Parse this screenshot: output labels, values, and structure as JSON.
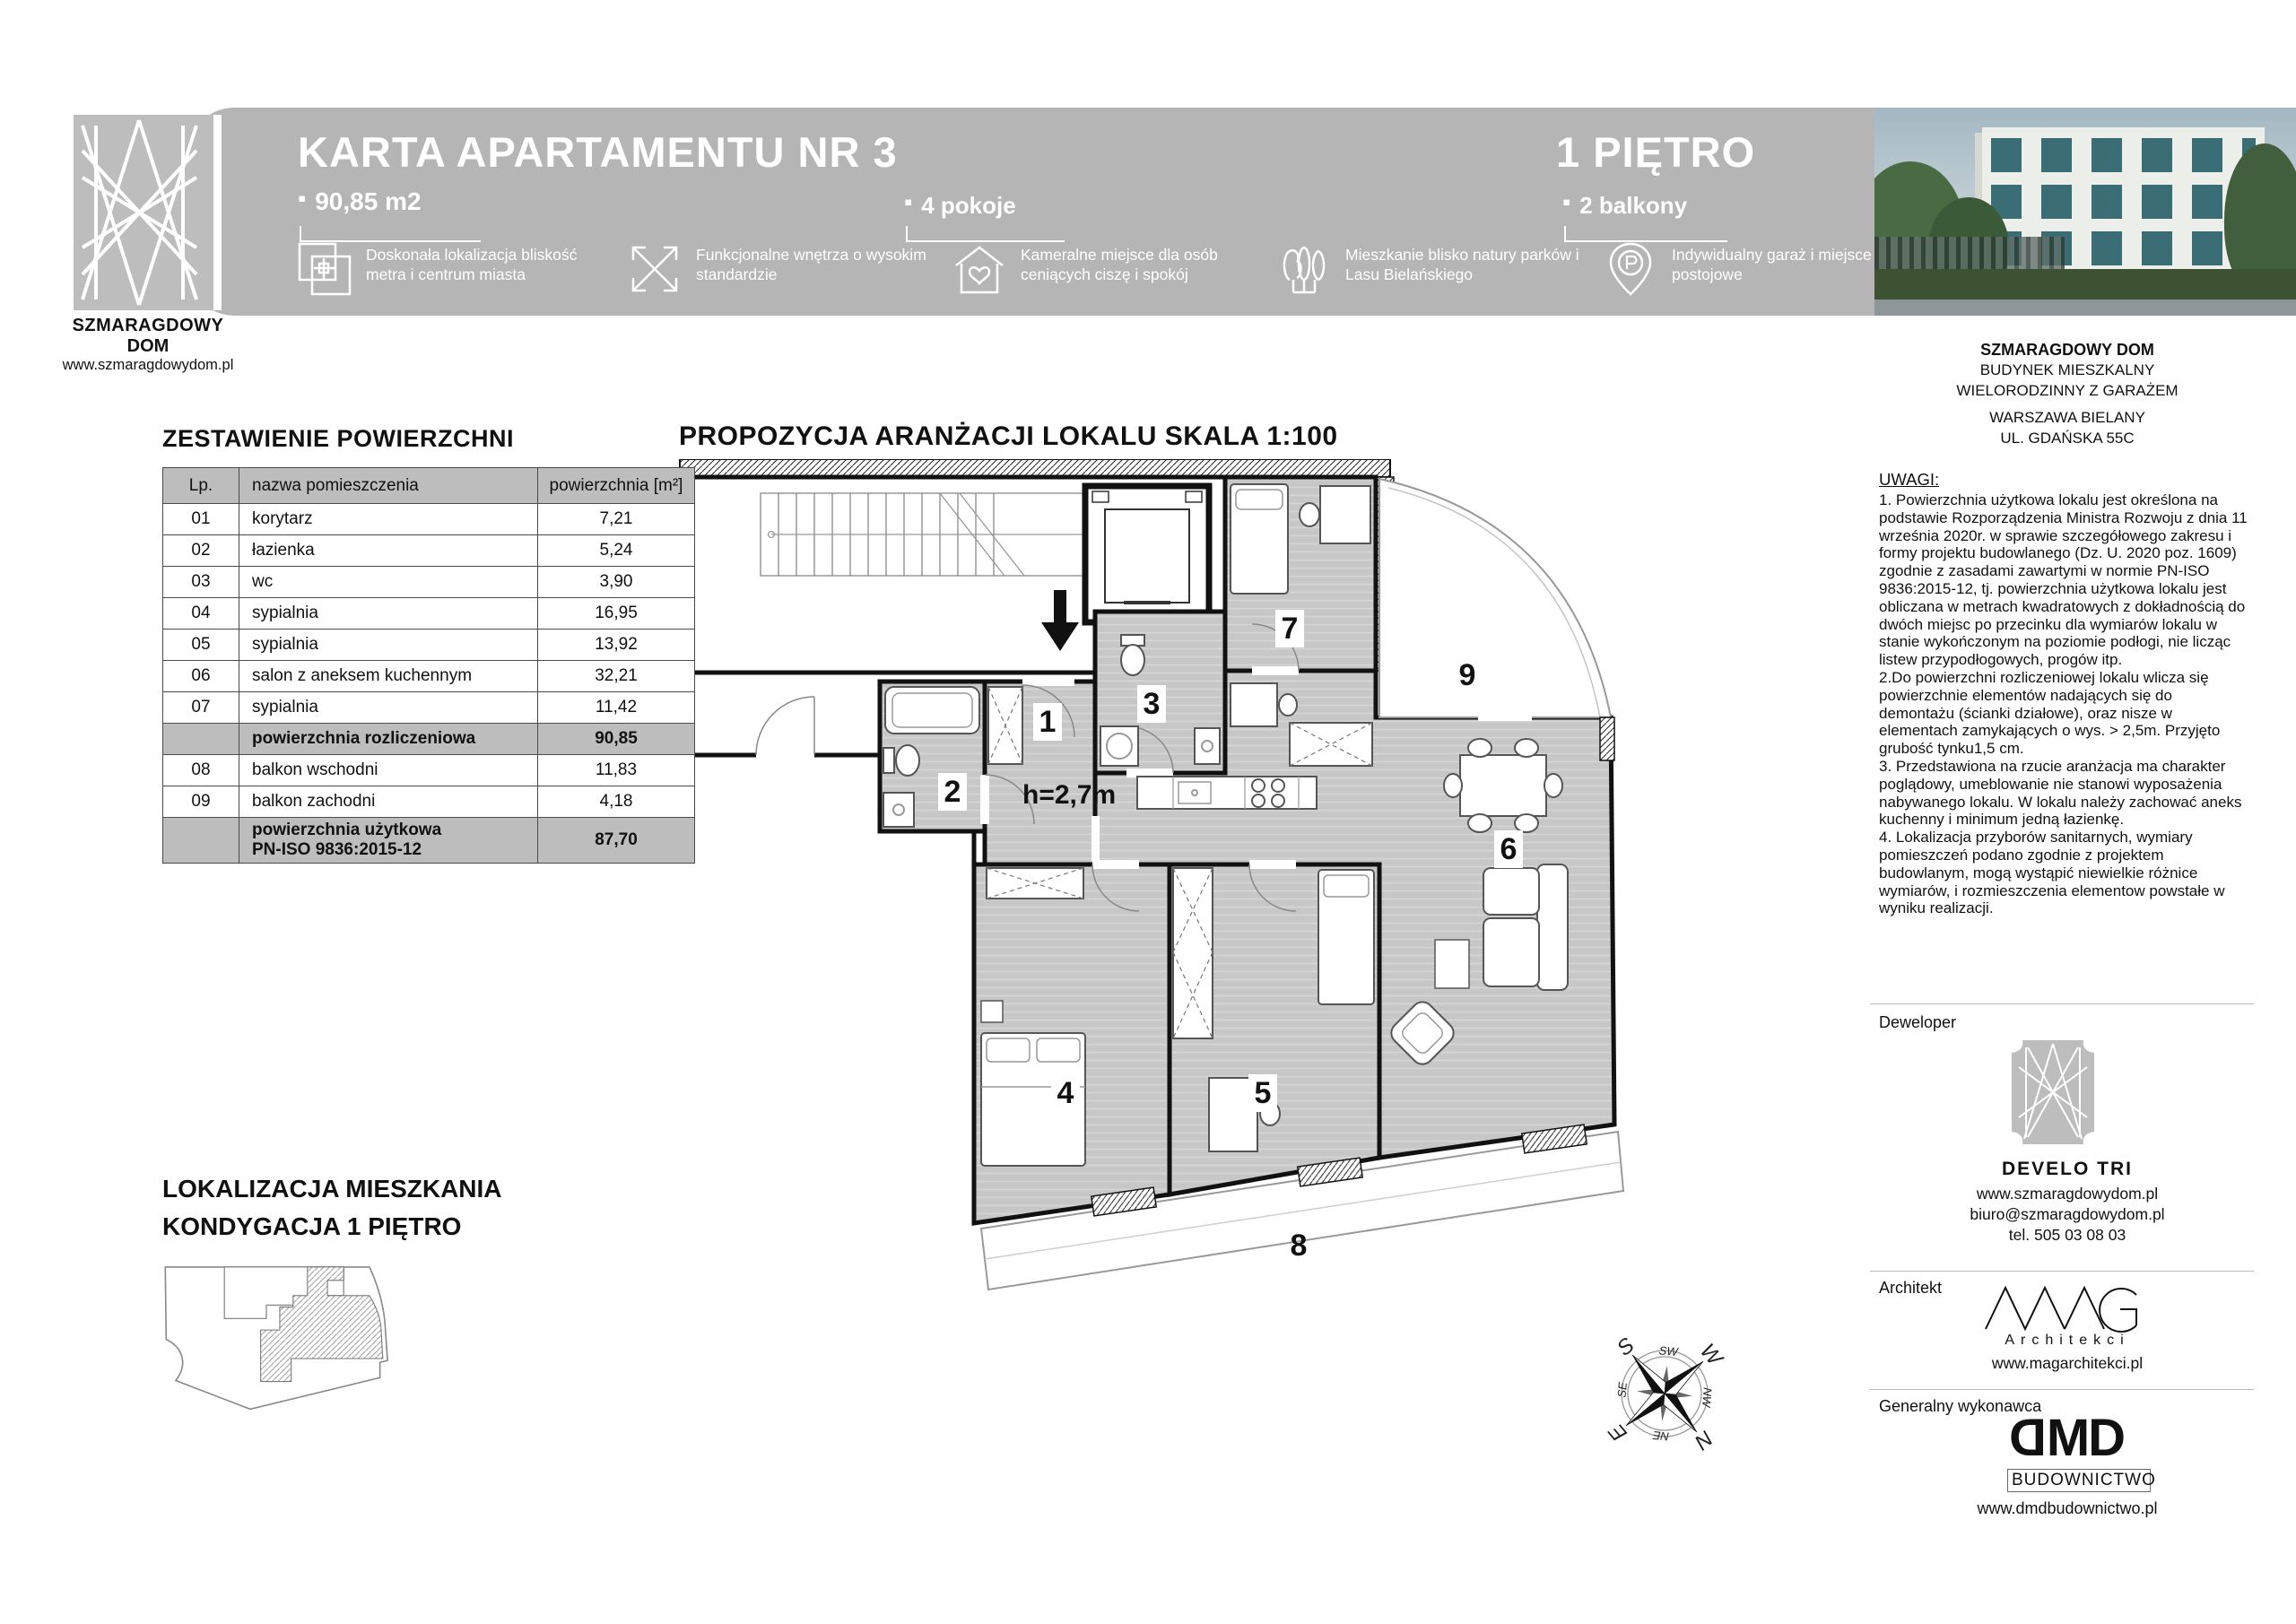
{
  "brand": {
    "line1": "SZMARAGDOWY",
    "line2": "DOM",
    "url": "www.szmaragdowydom.pl"
  },
  "header": {
    "title": "KARTA APARTAMENTU NR 3",
    "area": "90,85 m2",
    "rooms": "4 pokoje",
    "floor": "1 PIĘTRO",
    "balconies": "2 balkony",
    "bullet": "▪",
    "features": [
      {
        "icon": "location-squares-icon",
        "text": "Doskonała lokalizacja bliskość metra i centrum miasta"
      },
      {
        "icon": "expand-arrows-icon",
        "text": "Funkcjonalne wnętrza o wysokim standardzie"
      },
      {
        "icon": "house-heart-icon",
        "text": "Kameralne miejsce dla osób ceniących ciszę i spokój"
      },
      {
        "icon": "trees-icon",
        "text": "Mieszkanie blisko natury parków i Lasu Bielańskiego"
      },
      {
        "icon": "parking-pin-icon",
        "text": "Indywidualny garaż i miejsce postojowe"
      }
    ]
  },
  "areas": {
    "heading": "ZESTAWIENIE POWIERZCHNI",
    "columns": {
      "lp": "Lp.",
      "name": "nazwa pomieszczenia",
      "area": "powierzchnia [m²]"
    },
    "rows": [
      {
        "lp": "01",
        "name": "korytarz",
        "area": "7,21",
        "subtotal": false
      },
      {
        "lp": "02",
        "name": "łazienka",
        "area": "5,24",
        "subtotal": false
      },
      {
        "lp": "03",
        "name": "wc",
        "area": "3,90",
        "subtotal": false
      },
      {
        "lp": "04",
        "name": "sypialnia",
        "area": "16,95",
        "subtotal": false
      },
      {
        "lp": "05",
        "name": "sypialnia",
        "area": "13,92",
        "subtotal": false
      },
      {
        "lp": "06",
        "name": "salon z aneksem kuchennym",
        "area": "32,21",
        "subtotal": false
      },
      {
        "lp": "07",
        "name": "sypialnia",
        "area": "11,42",
        "subtotal": false
      },
      {
        "lp": "",
        "name": "powierzchnia rozliczeniowa",
        "area": "90,85",
        "subtotal": true
      },
      {
        "lp": "08",
        "name": "balkon wschodni",
        "area": "11,83",
        "subtotal": false
      },
      {
        "lp": "09",
        "name": "balkon zachodni",
        "area": "4,18",
        "subtotal": false
      },
      {
        "lp": "",
        "name": "powierzchnia użytkowa",
        "name2": "PN-ISO 9836:2015-12",
        "area": "87,70",
        "subtotal": true
      }
    ]
  },
  "plan": {
    "heading": "PROPOZYCJA ARANŻACJI LOKALU SKALA 1:100",
    "height_label": "h=2,7m",
    "rooms": [
      "1",
      "2",
      "3",
      "4",
      "5",
      "6",
      "7",
      "8",
      "9"
    ],
    "compass": {
      "n": "N",
      "e": "E",
      "s": "S",
      "w": "W",
      "ne": "NE",
      "nw": "NW",
      "se": "SE",
      "sw": "SW"
    }
  },
  "location": {
    "heading_line1": "LOKALIZACJA MIESZKANIA",
    "heading_line2": "KONDYGACJA 1 PIĘTRO"
  },
  "sidebar": {
    "project_lines": [
      "SZMARAGDOWY DOM",
      "BUDYNEK MIESZKALNY",
      "WIELORODZINNY Z GARAŻEM"
    ],
    "address_lines": [
      "WARSZAWA BIELANY",
      "UL. GDAŃSKA 55C"
    ],
    "notes_heading": "UWAGI:",
    "notes": [
      "1. Powierzchnia użytkowa lokalu jest określona na podstawie Rozporządzenia Ministra Rozwoju z dnia 11 września 2020r. w sprawie szczegółowego zakresu i formy projektu budowlanego (Dz. U. 2020 poz. 1609) zgodnie z zasadami zawartymi w normie PN-ISO 9836:2015-12, tj. powierzchnia użytkowa lokalu jest obliczana w metrach kwadratowych z dokładnością do dwóch miejsc po przecinku dla wymiarów lokalu w stanie wykończonym na poziomie podłogi, nie licząc listew przypodłogowych, progów itp.",
      "2.Do powierzchni rozliczeniowej lokalu wlicza się powierzchnie elementów nadających się do demontażu (ścianki działowe), oraz nisze w elementach zamykających o wys. > 2,5m. Przyjęto grubość tynku1,5 cm.",
      "3. Przedstawiona na rzucie aranżacja ma charakter poglądowy, umeblowanie nie stanowi wyposażenia nabywanego lokalu. W lokalu należy zachować aneks kuchenny i minimum jedną łazienkę.",
      "4. Lokalizacja przyborów sanitarnych, wymiary pomieszczeń podano zgodnie z projektem budowlanym, mogą wystąpić niewielkie różnice wymiarów, i rozmieszczenia elementow powstałe w wyniku realizacji."
    ],
    "developer": {
      "label": "Deweloper",
      "name": "DEVELO TRI",
      "www": "www.szmaragdowydom.pl",
      "email": "biuro@szmaragdowydom.pl",
      "tel": "tel. 505 03 08 03"
    },
    "architect": {
      "label": "Architekt",
      "logo_sub": "Architekci",
      "www": "www.magarchitekci.pl"
    },
    "contractor": {
      "label": "Generalny wykonawca",
      "logo_first": "D",
      "logo_rest": "MD",
      "logo_sub": "BUDOWNICTWO",
      "www": "www.dmdbudownictwo.pl"
    }
  }
}
